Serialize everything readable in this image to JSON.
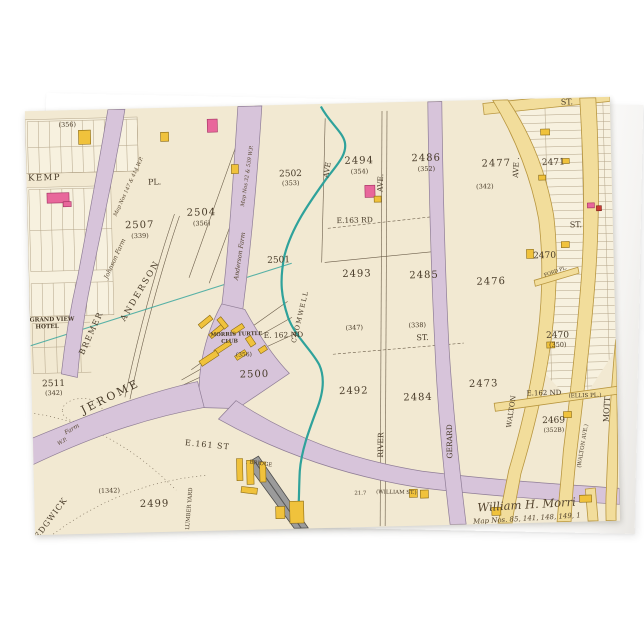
{
  "scene": {
    "background": "#ffffff",
    "product": "folded greeting card mockup with vintage atlas map artwork"
  },
  "palette": {
    "parchment": "#f2e9d2",
    "parchment_light": "#f7f1df",
    "street_purple": "#d7c4da",
    "street_purple_edge": "#8f7d96",
    "street_yellow": "#f2dd9b",
    "street_yellow_edge": "#b8963f",
    "building_yellow": "#f0c23c",
    "building_yellow_edge": "#8a6a14",
    "building_pink": "#e8679b",
    "building_pink_edge": "#a03060",
    "building_red": "#cc3b33",
    "creek_teal": "#2fa29b",
    "ink": "#473a28",
    "ink_soft": "#6b5d49",
    "grid_line": "#b3a488",
    "rail_gray": "#9b9b9b",
    "rail_edge": "#4c4c4c"
  },
  "map": {
    "width": 585,
    "height": 423,
    "labels": [
      {
        "text": "(356)",
        "x": 42,
        "y": 16,
        "fs": 6.5
      },
      {
        "text": "KEMP",
        "x": 18,
        "y": 69,
        "fs": 8.5,
        "sp": 1.5
      },
      {
        "text": "PL.",
        "x": 128,
        "y": 76,
        "fs": 8
      },
      {
        "text": "2507",
        "x": 112,
        "y": 119,
        "fs": 10,
        "sp": 1
      },
      {
        "text": "(339)",
        "x": 112,
        "y": 129,
        "fs": 6.5
      },
      {
        "text": "2504",
        "x": 174,
        "y": 108,
        "fs": 10,
        "sp": 1
      },
      {
        "text": "(356)",
        "x": 174,
        "y": 118,
        "fs": 6.5
      },
      {
        "text": "2501",
        "x": 250,
        "y": 157,
        "fs": 9
      },
      {
        "text": "2502",
        "x": 264,
        "y": 71,
        "fs": 9
      },
      {
        "text": "(353)",
        "x": 264,
        "y": 80,
        "fs": 6.5
      },
      {
        "text": "2511",
        "x": 22,
        "y": 275,
        "fs": 9
      },
      {
        "text": "(342)",
        "x": 22,
        "y": 284,
        "fs": 6.5
      },
      {
        "text": "GRAND VIEW",
        "x": 22,
        "y": 210,
        "fs": 5.8,
        "b": 1
      },
      {
        "text": "HOTEL",
        "x": 17,
        "y": 217,
        "fs": 5.8,
        "b": 1
      },
      {
        "text": "ANDERSON",
        "x": 113,
        "y": 183,
        "fs": 8.5,
        "rot": -58,
        "sp": 2
      },
      {
        "text": "BREMER",
        "x": 63,
        "y": 224,
        "fs": 8,
        "rot": -64,
        "sp": 1.5
      },
      {
        "text": "Johnson Farm",
        "x": 88,
        "y": 150,
        "fs": 6.2,
        "rot": -64,
        "i": 1
      },
      {
        "text": "Map Nos 147 & 414 W.P.",
        "x": 103,
        "y": 78,
        "fs": 5.2,
        "rot": -64,
        "i": 1
      },
      {
        "text": "Anderson Farm",
        "x": 213,
        "y": 150,
        "fs": 6.2,
        "rot": -80,
        "i": 1
      },
      {
        "text": "Map Nos 32 & 539 W.P.",
        "x": 222,
        "y": 70,
        "fs": 5.2,
        "rot": -80,
        "i": 1
      },
      {
        "text": "JEROME",
        "x": 80,
        "y": 290,
        "fs": 11,
        "rot": -25,
        "sp": 2.5
      },
      {
        "text": "Farm",
        "x": 40,
        "y": 320,
        "fs": 6,
        "rot": -28,
        "i": 1
      },
      {
        "text": "W.P.",
        "x": 30,
        "y": 332,
        "fs": 5.2,
        "rot": -28,
        "i": 1
      },
      {
        "text": "MORRIS TURTLE",
        "x": 206,
        "y": 229,
        "fs": 5.3,
        "b": 1
      },
      {
        "text": "CLUB",
        "x": 199,
        "y": 236,
        "fs": 5.3,
        "b": 1
      },
      {
        "text": "(356)",
        "x": 213,
        "y": 250,
        "fs": 6
      },
      {
        "text": "E. 162 ND",
        "x": 253,
        "y": 232,
        "fs": 7.5
      },
      {
        "text": "2500",
        "x": 223,
        "y": 271,
        "fs": 10,
        "sp": 1
      },
      {
        "text": "CROMWELL",
        "x": 272,
        "y": 212,
        "fs": 6.5,
        "rot": -75,
        "sp": 1.5
      },
      {
        "text": "2493",
        "x": 328,
        "y": 173,
        "fs": 10,
        "sp": 1
      },
      {
        "text": "2485",
        "x": 395,
        "y": 176,
        "fs": 10,
        "sp": 1
      },
      {
        "text": "2494",
        "x": 333,
        "y": 60,
        "fs": 10,
        "sp": 1
      },
      {
        "text": "(354)",
        "x": 333,
        "y": 70,
        "fs": 6.5
      },
      {
        "text": "2486",
        "x": 400,
        "y": 59,
        "fs": 10,
        "sp": 1
      },
      {
        "text": "(352)",
        "x": 400,
        "y": 69,
        "fs": 6.5
      },
      {
        "text": "E.163 RD",
        "x": 327,
        "y": 119,
        "fs": 7.5
      },
      {
        "text": "2492",
        "x": 322,
        "y": 290,
        "fs": 10,
        "sp": 1
      },
      {
        "text": "2484",
        "x": 386,
        "y": 298,
        "fs": 10,
        "sp": 1
      },
      {
        "text": "(347)",
        "x": 324,
        "y": 226,
        "fs": 6.5
      },
      {
        "text": "(338)",
        "x": 387,
        "y": 225,
        "fs": 6.5
      },
      {
        "text": "ST.",
        "x": 392,
        "y": 238,
        "fs": 8
      },
      {
        "text": "AVE",
        "x": 303,
        "y": 66,
        "fs": 7.5,
        "rot": -80
      },
      {
        "text": "AVE.",
        "x": 356,
        "y": 80,
        "fs": 7.5,
        "rot": -86
      },
      {
        "text": "RIVER",
        "x": 350,
        "y": 342,
        "fs": 7.5,
        "rot": -88
      },
      {
        "text": "GERARD",
        "x": 419,
        "y": 340,
        "fs": 7.5,
        "rot": -89
      },
      {
        "text": "AVE .",
        "x": 492,
        "y": 68,
        "fs": 7.5,
        "rot": -86
      },
      {
        "text": "2477",
        "x": 470,
        "y": 66,
        "fs": 10,
        "sp": 1
      },
      {
        "text": "(342)",
        "x": 458,
        "y": 88,
        "fs": 6.5
      },
      {
        "text": "2471",
        "x": 527,
        "y": 66,
        "fs": 9
      },
      {
        "text": "2476",
        "x": 462,
        "y": 184,
        "fs": 10,
        "sp": 1
      },
      {
        "text": "2470",
        "x": 516,
        "y": 159,
        "fs": 9
      },
      {
        "text": "ST.",
        "x": 548,
        "y": 129,
        "fs": 8
      },
      {
        "text": "ST.",
        "x": 542,
        "y": 6,
        "fs": 8
      },
      {
        "text": "2473",
        "x": 452,
        "y": 286,
        "fs": 10,
        "sp": 1
      },
      {
        "text": "2470",
        "x": 527,
        "y": 239,
        "fs": 9
      },
      {
        "text": "(350)",
        "x": 527,
        "y": 248,
        "fs": 6.5
      },
      {
        "text": "E.162 ND",
        "x": 512,
        "y": 296,
        "fs": 7
      },
      {
        "text": "(ELLIS PL.)",
        "x": 553,
        "y": 299,
        "fs": 5.6
      },
      {
        "text": "2469",
        "x": 521,
        "y": 324,
        "fs": 9
      },
      {
        "text": "(352B)",
        "x": 521,
        "y": 333,
        "fs": 6
      },
      {
        "text": "WALTON",
        "x": 481,
        "y": 312,
        "fs": 7,
        "rot": -80
      },
      {
        "text": "(WALTON AVE.)",
        "x": 551,
        "y": 348,
        "fs": 5.4,
        "rot": -79
      },
      {
        "text": "MOTT",
        "x": 577,
        "y": 312,
        "fs": 8,
        "rot": -86
      },
      {
        "text": "FORD PL.",
        "x": 527,
        "y": 174,
        "fs": 4.8,
        "rot": -18
      },
      {
        "text": "E.161 ST",
        "x": 174,
        "y": 340,
        "fs": 8,
        "rot": 7,
        "sp": 1
      },
      {
        "text": "BRIDGE",
        "x": 227,
        "y": 359,
        "fs": 5.4,
        "rot": 10
      },
      {
        "text": "21.7",
        "x": 326,
        "y": 391,
        "fs": 5.4,
        "rot": 2
      },
      {
        "text": "(WILLIAM ST.)",
        "x": 362,
        "y": 391,
        "fs": 5.4,
        "rot": 2
      },
      {
        "text": "2499",
        "x": 120,
        "y": 398,
        "fs": 10,
        "sp": 1
      },
      {
        "text": "(1342)",
        "x": 75,
        "y": 383,
        "fs": 6.5
      },
      {
        "text": "SEDGWICK",
        "x": 16,
        "y": 411,
        "fs": 8,
        "rot": -52,
        "sp": 1
      },
      {
        "text": "LUMBER YARD",
        "x": 156,
        "y": 401,
        "fs": 5.4,
        "rot": -84
      },
      {
        "text": "William H. Morri",
        "x": 492,
        "y": 409,
        "fs": 11.5,
        "i": 1,
        "rot": -2
      },
      {
        "text": "Map Nos. 85, 141, 148, 149, 1",
        "x": 492,
        "y": 421,
        "fs": 7,
        "i": 1,
        "rot": -2
      }
    ]
  }
}
